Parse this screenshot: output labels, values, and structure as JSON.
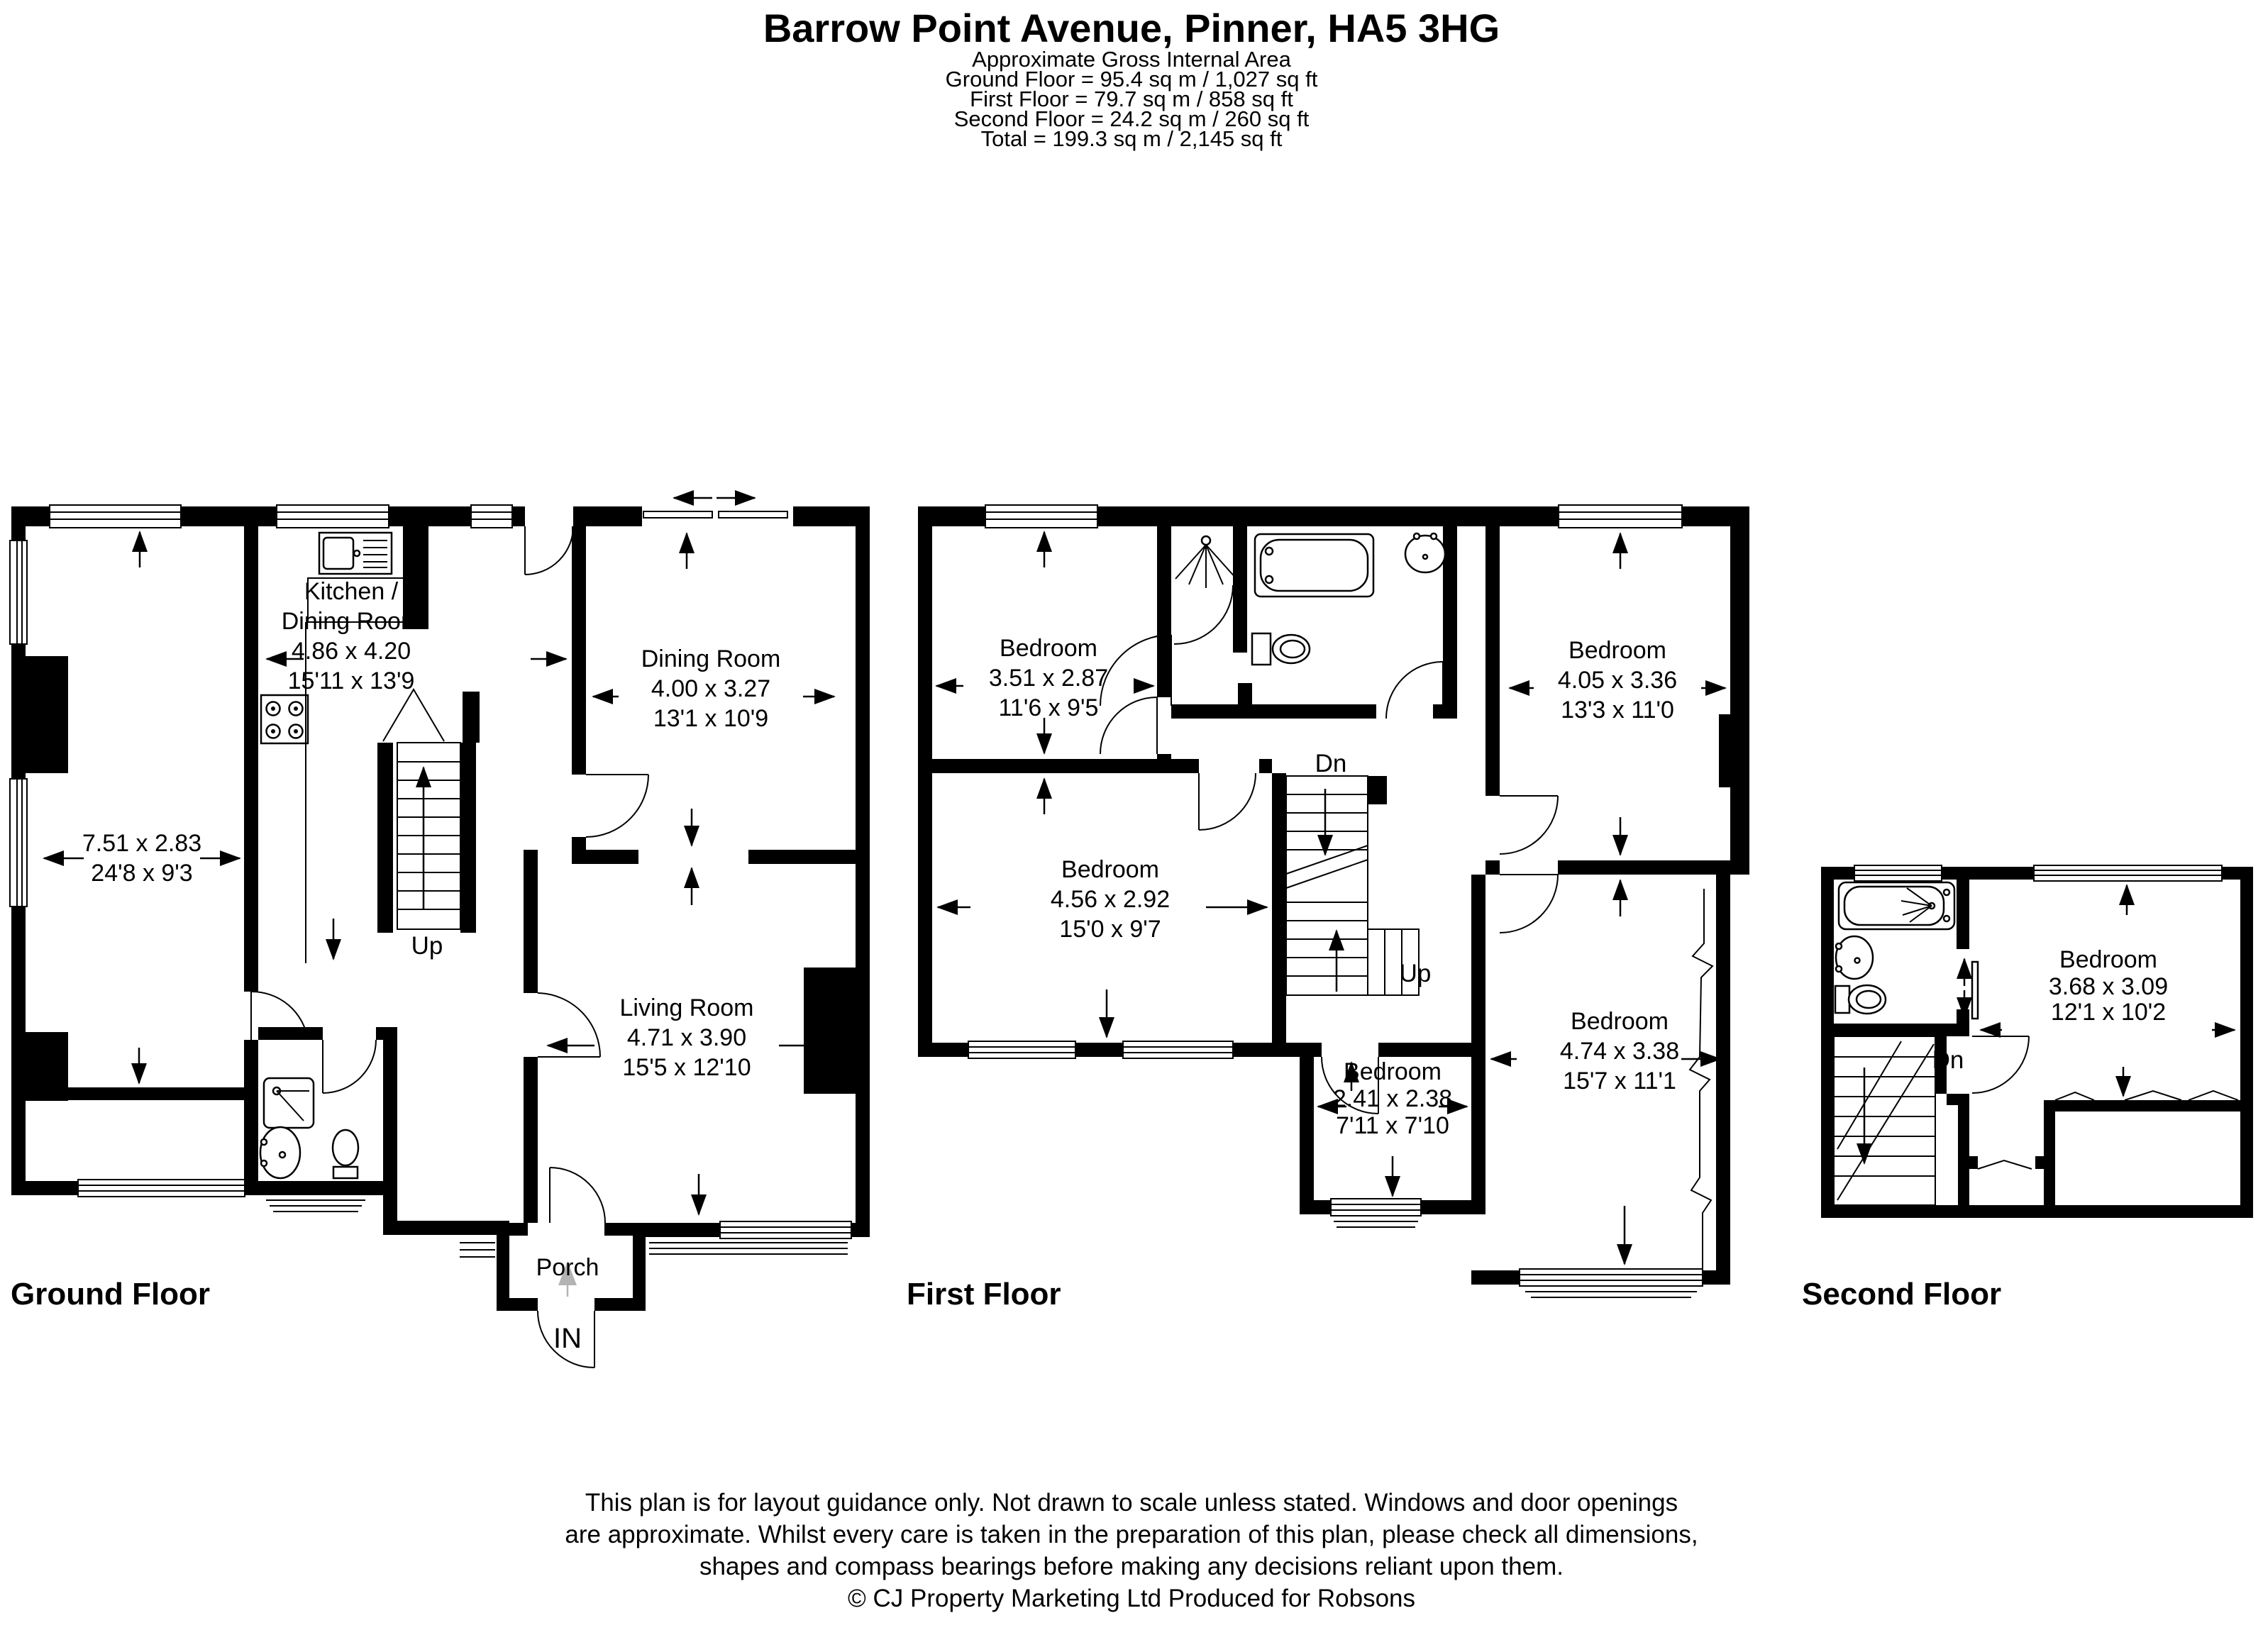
{
  "header": {
    "title": "Barrow Point Avenue, Pinner, HA5 3HG",
    "subtitle": "Approximate Gross Internal Area",
    "areas": [
      "Ground Floor = 95.4 sq m / 1,027 sq ft",
      "First Floor = 79.7 sq m / 858 sq ft",
      "Second Floor = 24.2 sq m / 260 sq ft",
      "Total = 199.3 sq m / 2,145 sq ft"
    ]
  },
  "floors": {
    "ground": {
      "label": "Ground Floor",
      "up_label": "Up",
      "porch_label": "Porch",
      "in_label": "IN",
      "rooms": {
        "reception": {
          "dim_m": "7.51 x 2.83",
          "dim_ft": "24'8 x 9'3"
        },
        "kitchen": {
          "name_l1": "Kitchen /",
          "name_l2": "Dining Room",
          "dim_m": "4.86 x 4.20",
          "dim_ft": "15'11 x 13'9"
        },
        "dining": {
          "name": "Dining Room",
          "dim_m": "4.00 x 3.27",
          "dim_ft": "13'1 x 10'9"
        },
        "living": {
          "name": "Living Room",
          "dim_m": "4.71 x 3.90",
          "dim_ft": "15'5 x 12'10"
        }
      }
    },
    "first": {
      "label": "First Floor",
      "down_label": "Dn",
      "up_label": "Up",
      "rooms": {
        "bedroom1": {
          "name": "Bedroom",
          "dim_m": "3.51 x 2.87",
          "dim_ft": "11'6 x 9'5"
        },
        "bedroom2": {
          "name": "Bedroom",
          "dim_m": "4.56 x 2.92",
          "dim_ft": "15'0 x 9'7"
        },
        "bedroom3": {
          "name": "Bedroom",
          "dim_m": "4.05 x 3.36",
          "dim_ft": "13'3 x 11'0"
        },
        "bedroom4": {
          "name": "Bedroom",
          "dim_m": "4.74 x 3.38",
          "dim_ft": "15'7 x 11'1"
        },
        "bedroom5": {
          "name": "Bedroom",
          "dim_m": "2.41 x 2.38",
          "dim_ft": "7'11 x 7'10"
        }
      }
    },
    "second": {
      "label": "Second Floor",
      "down_label": "Dn",
      "rooms": {
        "bedroom": {
          "name": "Bedroom",
          "dim_m": "3.68 x 3.09",
          "dim_ft": "12'1 x 10'2"
        }
      }
    }
  },
  "disclaimer": [
    "This plan is for layout guidance only. Not drawn to scale unless stated. Windows and door openings",
    "are approximate. Whilst every care is taken in the preparation of this plan, please check all dimensions,",
    "shapes and compass bearings before making any decisions reliant upon them.",
    "© CJ Property Marketing Ltd Produced for Robsons"
  ]
}
